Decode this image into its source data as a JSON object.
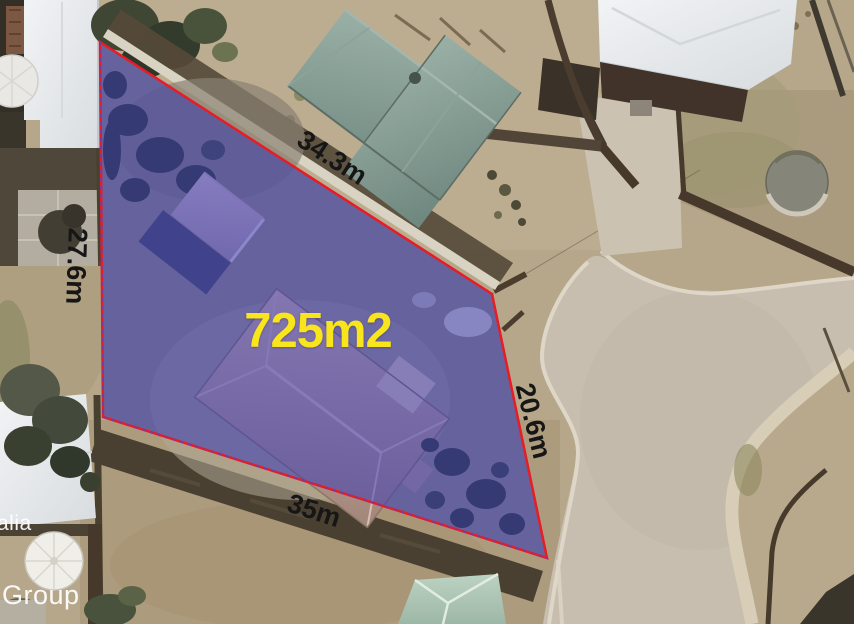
{
  "view": {
    "description": "Aerial photograph of a residential street with a highlighted land parcel for sale"
  },
  "parcel": {
    "area_label": "725m2",
    "dimensions": [
      {
        "edge": "north",
        "label": "34.3m"
      },
      {
        "edge": "west",
        "label": "27.6m"
      },
      {
        "edge": "east",
        "label": "20.6m"
      },
      {
        "edge": "south",
        "label": "35m"
      }
    ],
    "colors": {
      "fill": "rgba(50,52,185,0.5)",
      "boundary": "#e81c24",
      "area_text": "#f8e51c",
      "dimension_text": "#161616"
    }
  },
  "watermark": {
    "line1": "alia",
    "line2": "Group",
    "color": "#ffffff"
  }
}
